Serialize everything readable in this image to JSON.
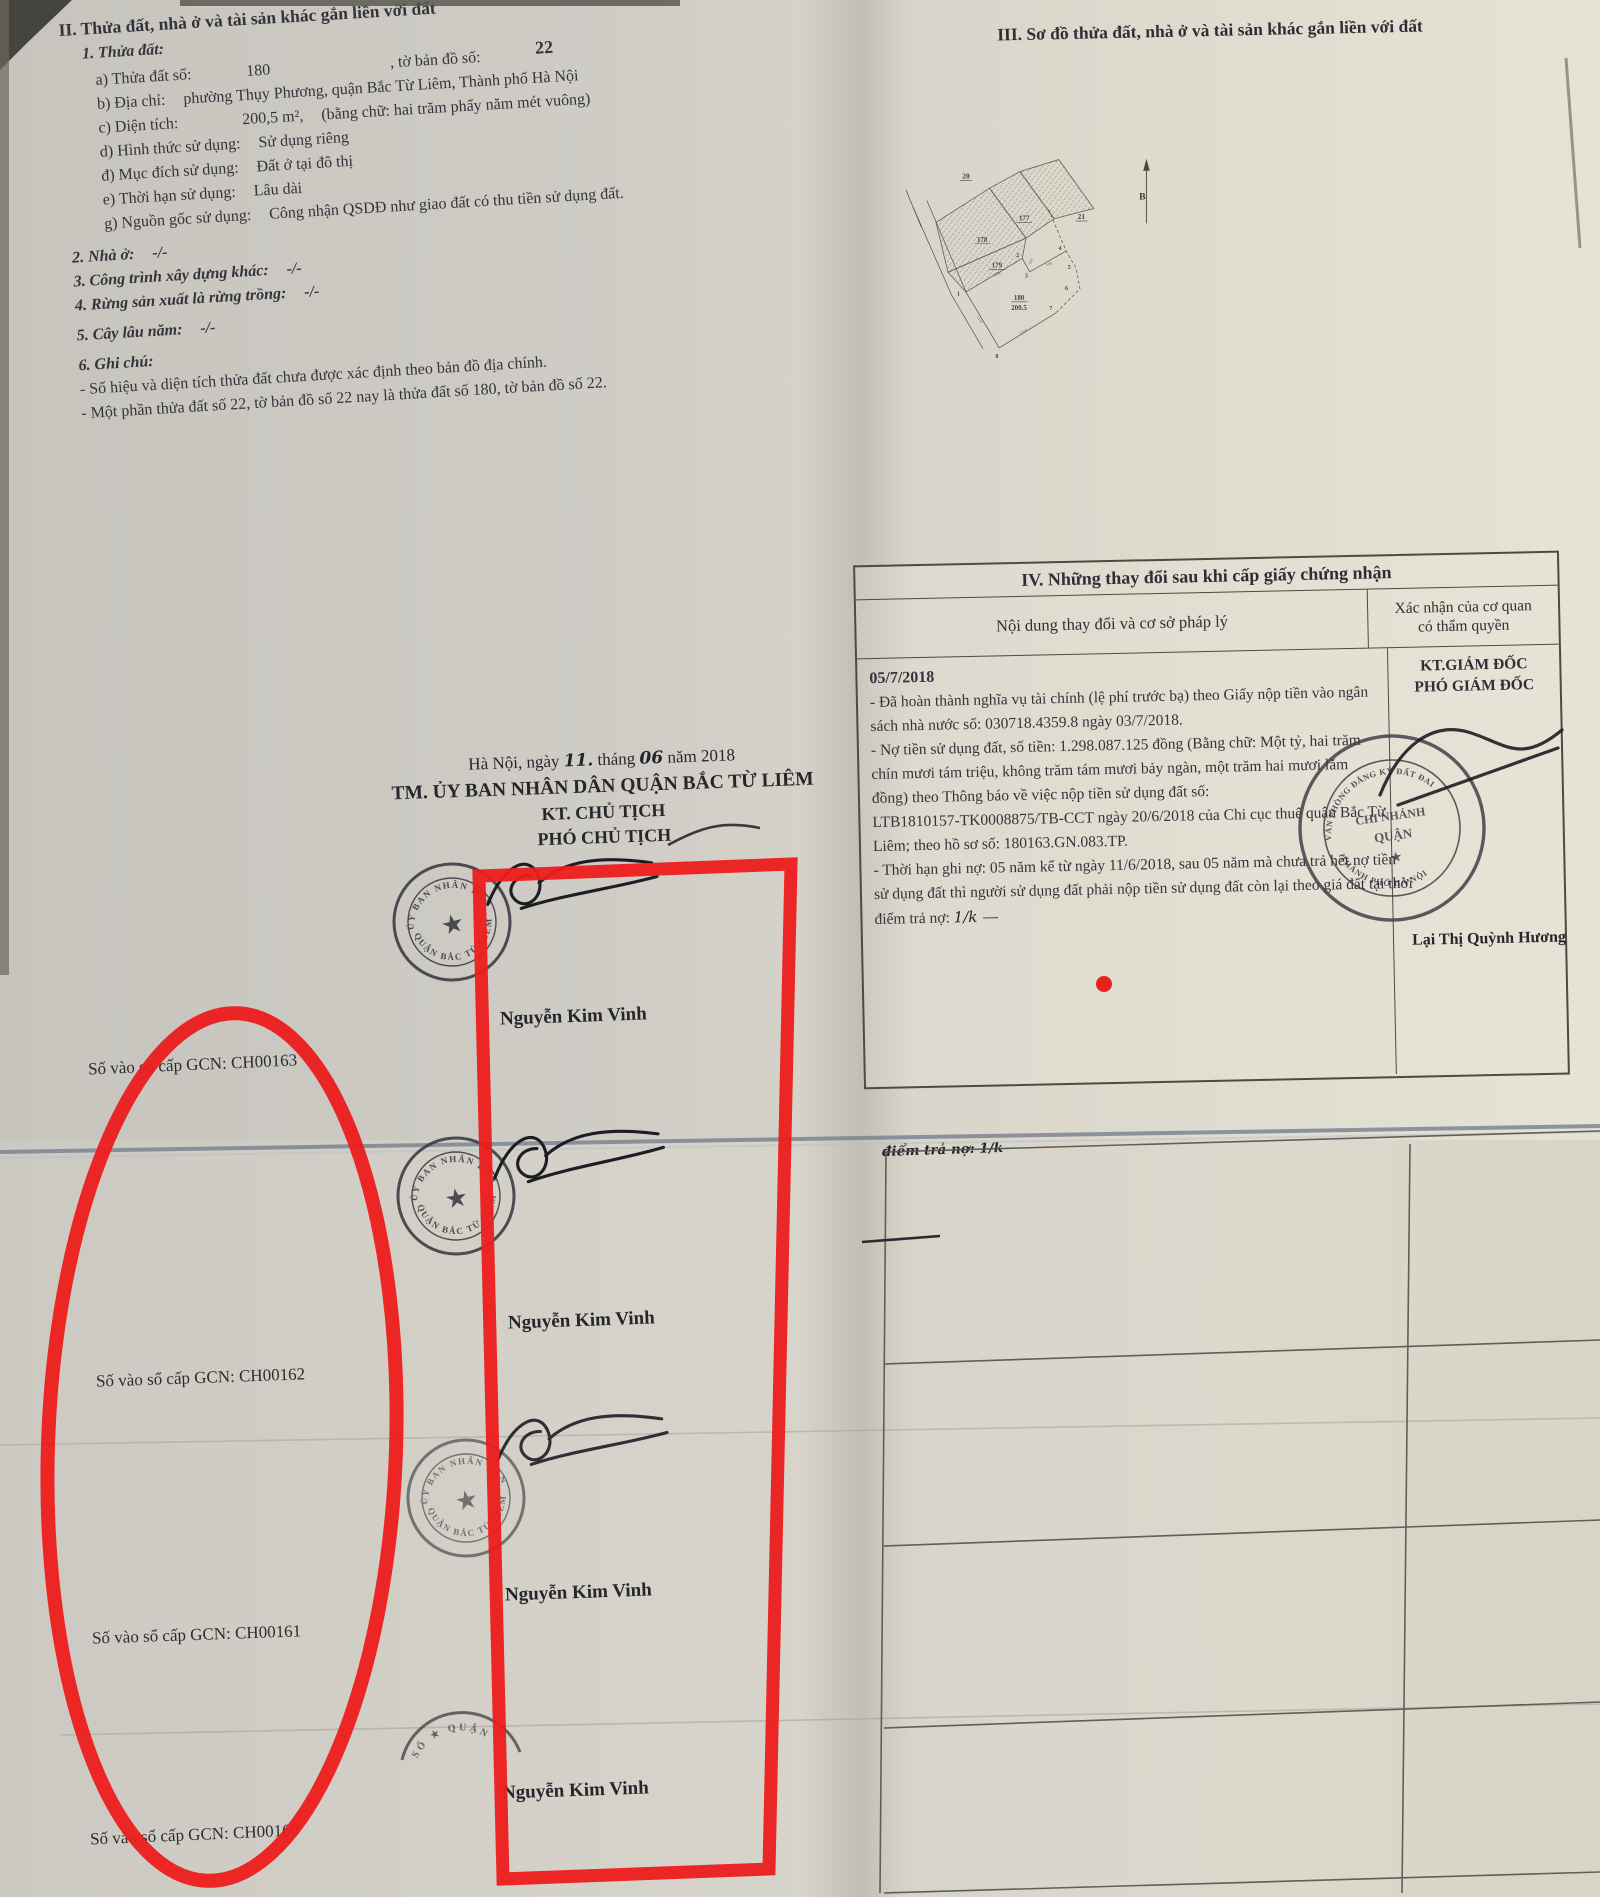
{
  "section2": {
    "title": "II. Thửa đất, nhà ở và tài sản khác gắn liền với đất",
    "item1": "1. Thửa đất:",
    "a_label": "a) Thửa đất số:",
    "a_value": "180",
    "a_label2": ", tờ bản đồ số:",
    "a_value2": "22",
    "b_label": "b) Địa chỉ:",
    "b_value": "phường Thụy Phương, quận Bắc Từ Liêm, Thành phố Hà Nội",
    "c_label": "c) Diện tích:",
    "c_value": "200,5 m²,",
    "c_value2": "(bằng chữ: hai trăm phẩy năm mét vuông)",
    "d_label": "d) Hình thức sử dụng:",
    "d_value": "Sử dụng riêng",
    "dd_label": "đ) Mục đích sử dụng:",
    "dd_value": "Đất ở tại đô thị",
    "e_label": "e) Thời hạn sử dụng:",
    "e_value": "Lâu dài",
    "g_label": "g) Nguồn gốc sử dụng:",
    "g_value": "Công nhận QSDĐ như giao đất có thu tiền sử dụng đất.",
    "item2": "2. Nhà ở:",
    "item2_value": "-/-",
    "item3": "3. Công trình xây dựng khác:",
    "item3_value": "-/-",
    "item4": "4. Rừng sản xuất là rừng trồng:",
    "item4_value": "-/-",
    "item5": "5. Cây lâu năm:",
    "item5_value": "-/-",
    "item6": "6. Ghi chú:",
    "note1": "- Số hiệu và diện tích thửa đất chưa được xác định theo bản đồ địa chính.",
    "note2": "- Một phần thửa đất số 22, tờ bản đồ số 22 nay là thửa đất số 180, tờ bản đồ số 22."
  },
  "section3": {
    "title": "III. Sơ đồ thửa đất, nhà ở và tài sản khác gắn liền với đất"
  },
  "map": {
    "n20": "20",
    "n21": "21",
    "p177": "177",
    "p178": "178",
    "p179": "179",
    "p180": "180",
    "area180": "200.5",
    "v1": "1",
    "v2": "2",
    "v3": "3",
    "v4": "4",
    "v5": "5",
    "v6": "6",
    "v7": "7",
    "v8": "8",
    "e_1388": "13.88",
    "e_1357": "13.57",
    "e_1350": "13.50",
    "e_403": "4.03",
    "e_600": "6.00",
    "north": "B"
  },
  "section4": {
    "title": "IV. Những thay đổi sau khi cấp giấy chứng nhận",
    "col1": "Nội dung thay đổi và cơ sở pháp lý",
    "col2a": "Xác nhận của cơ quan",
    "col2b": "có thẩm quyền",
    "date": "05/7/2018",
    "content_lines": [
      "- Đã hoàn thành nghĩa vụ tài chính (lệ phí trước bạ) theo Giấy nộp tiền vào ngân",
      "sách nhà nước số: 030718.4359.8 ngày 03/7/2018.",
      "- Nợ tiền sử dụng đất, số tiền: 1.298.087.125 đồng (Bằng chữ: Một tỷ, hai trăm",
      "chín mươi tám triệu, không trăm tám mươi bảy ngàn, một trăm hai mươi lăm",
      "đồng) theo Thông báo về việc nộp tiền sử dụng đất số:",
      "LTB1810157-TK0008875/TB-CCT ngày 20/6/2018 của Chi cục thuế quận Bắc Từ",
      "Liêm; theo hồ sơ số: 180163.GN.083.TP.",
      "- Thời hạn ghi nợ: 05 năm kể từ ngày 11/6/2018, sau 05 năm mà chưa trả hết nợ tiền",
      "sử dụng đất thì người sử dụng đất phải nộp tiền sử dụng đất còn lại theo giá đất tại thời",
      "điểm trả nợ:"
    ],
    "approver_title1": "KT.GIÁM ĐỐC",
    "approver_title2": "PHÓ GIÁM ĐỐC",
    "approver_name": "Lại Thị Quỳnh Hương",
    "handwriting_note": "điểm trả nợ: 1/k"
  },
  "signing": {
    "date_prefix": "Hà Nội, ngày",
    "date_day": "11.",
    "date_mid": "tháng",
    "date_month": "06",
    "date_suffix": "năm 2018",
    "org": "TM. ỦY BAN NHÂN DÂN QUẬN BẮC TỪ LIÊM",
    "kt": "KT. CHỦ TỊCH",
    "deputy": "PHÓ CHỦ TỊCH",
    "signer_name": "Nguyễn Kim Vinh"
  },
  "registry": {
    "gcn": [
      "Số vào sổ cấp GCN: CH00163",
      "Số vào sổ cấp GCN: CH00162",
      "Số vào sổ cấp GCN: CH00161",
      "Số vào sổ cấp GCN: CH00160"
    ]
  },
  "stamp": {
    "arc_top": "ỦY BAN NHÂN DÂN",
    "arc_bottom": "QUẬN BẮC TỪ LIÊM",
    "star": "★",
    "partial_arc": "SỐ ★ QUẬN"
  },
  "big_stamp": {
    "arc_top": "VĂN PHÒNG ĐĂNG KÝ ĐẤT ĐAI",
    "arc_bottom": "THÀNH PHỐ HÀ NỘI",
    "center1": "CHI NHÁNH",
    "center2": "QUẬN",
    "star": "★"
  },
  "colors": {
    "annotation_red": "#ec1c1c",
    "ink": "#2e2e36"
  }
}
